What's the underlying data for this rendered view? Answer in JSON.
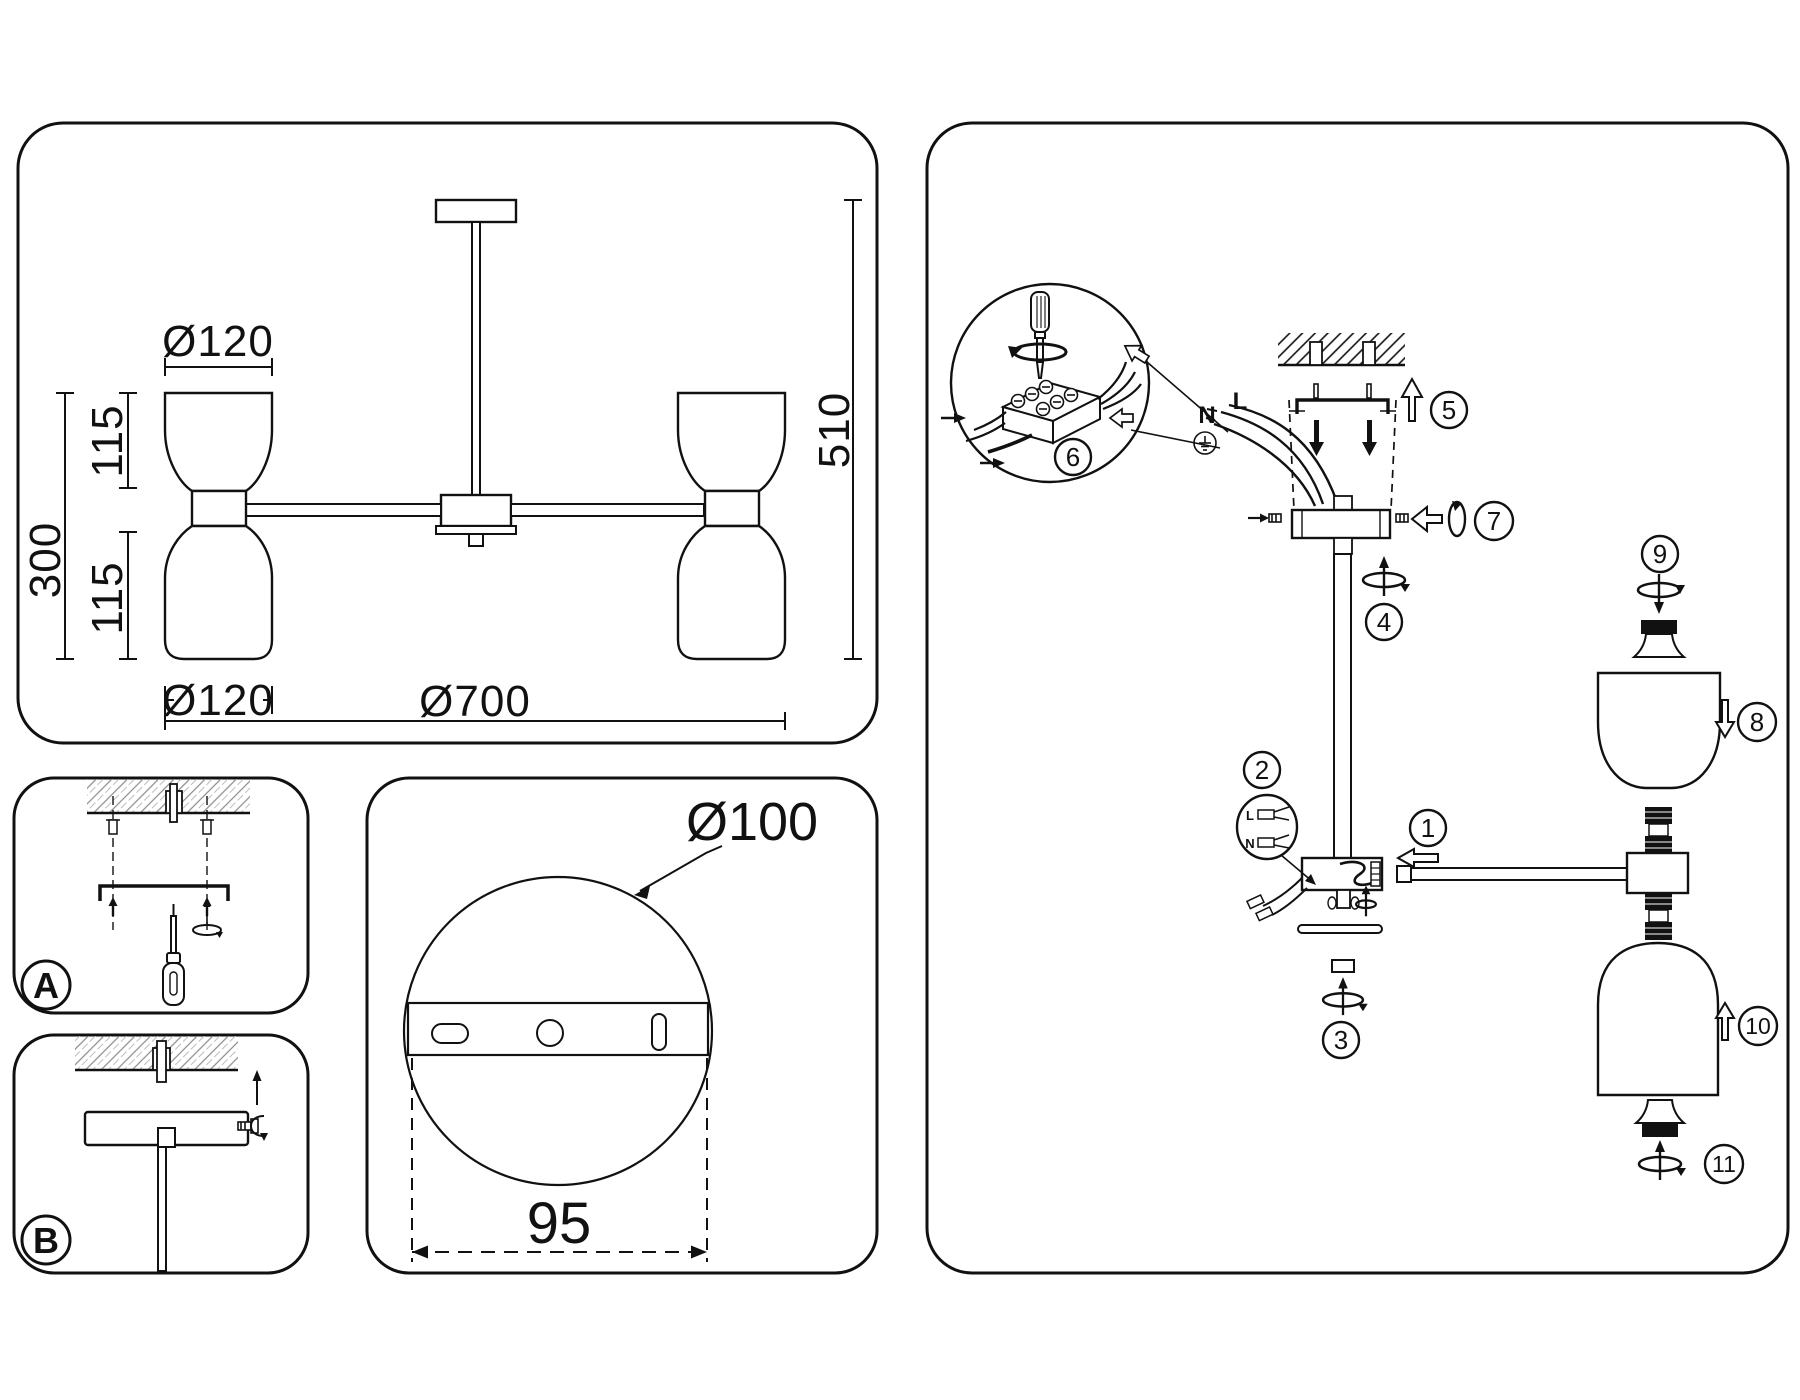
{
  "dims": {
    "shade_diameter_top": "Ø120",
    "shade_height_upper": "115",
    "shades_total_height": "300",
    "shade_height_lower": "115",
    "shade_diameter_bottom": "Ø120",
    "fixture_diameter": "Ø700",
    "fixture_height": "510"
  },
  "mounting": {
    "step_a_label": "A",
    "step_b_label": "B"
  },
  "canopy": {
    "diameter": "Ø100",
    "hole_spacing": "95"
  },
  "wiring": {
    "neutral": "N",
    "live": "L",
    "connector_live": "L",
    "connector_neutral": "N"
  },
  "steps": [
    "1",
    "2",
    "3",
    "4",
    "5",
    "6",
    "7",
    "8",
    "9",
    "10",
    "11"
  ]
}
